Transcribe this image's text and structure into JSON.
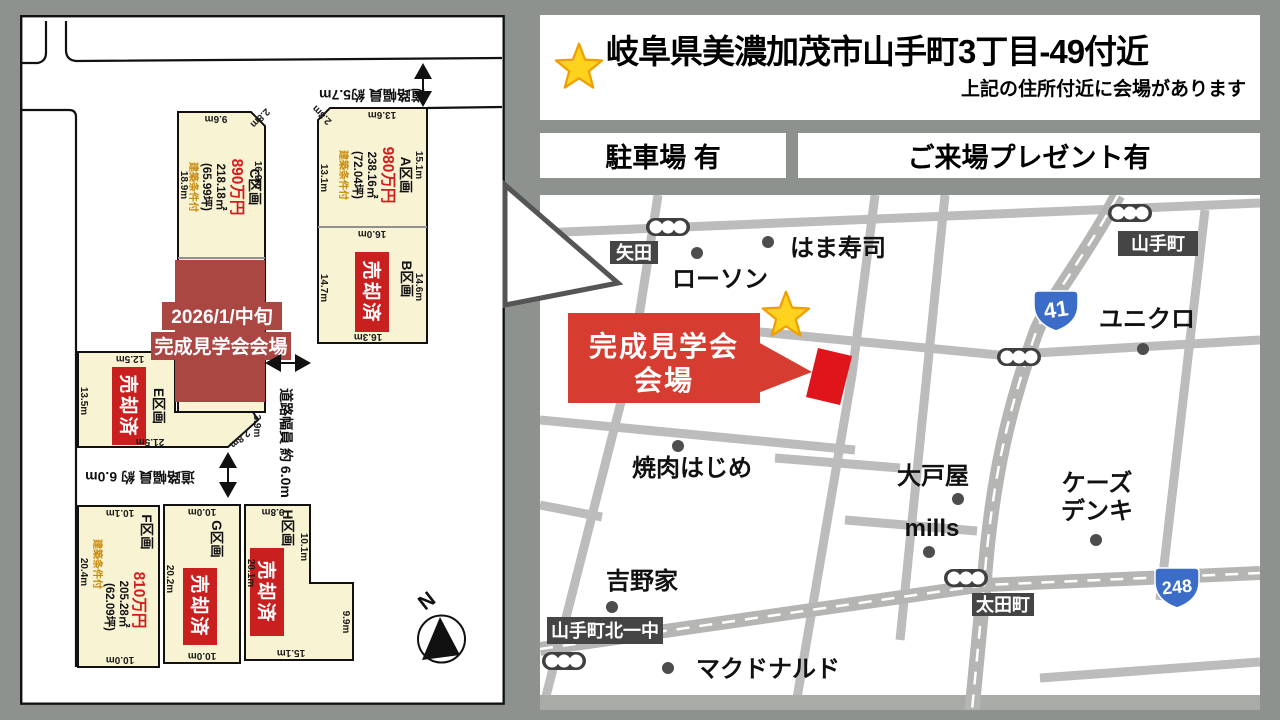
{
  "colors": {
    "page_bg": "#8e928f",
    "cream": "#f7f3d3",
    "sold_red": "#c91f1f",
    "price_red": "#d31c1c",
    "overlay_red": "#ab4743",
    "venue_red": "#d63c2f",
    "marker_red": "#e0151b",
    "condition_orange": "#c9890a",
    "road_gray": "#bcbcbc",
    "major_road_gray": "#b5b6b4",
    "label_dark": "#454545",
    "shield_blue": "#3a6cc8",
    "star_yellow": "#ffd21e",
    "star_border": "#ef9f00"
  },
  "header": {
    "title": "岐阜県美濃加茂市山手町3丁目‐49付近",
    "subtitle": "上記の住所付近に会場があります"
  },
  "badges": {
    "parking": "駐車場 有",
    "present": "ご来場プレゼント有"
  },
  "site_plan": {
    "overlay": {
      "line1": "2026/1/中旬",
      "line2": "完成見学会会場"
    },
    "sold_label": "売却済",
    "compass_label": "N",
    "road_notes": {
      "top": "道路幅員 約5.7m",
      "right": "道路幅員 約 6.0m",
      "bottom": "道路幅員 約 6.0m"
    },
    "plots": {
      "a": {
        "name": "A区画",
        "price": "980万円",
        "area": "238.16㎡",
        "tsubo": "(72.04坪)",
        "condition": "建築条件付",
        "dims": {
          "top": "13.6m",
          "corner": "2.8m",
          "right": "15.1m",
          "left": "13.1m",
          "bottom": "16.0m"
        }
      },
      "b": {
        "name": "B区画",
        "status": "売却済",
        "dims": {
          "right": "14.6m",
          "left": "14.7m",
          "bottom": "16.3m"
        }
      },
      "c": {
        "name": "C区画",
        "price": "890万円",
        "area": "218.18㎡",
        "tsubo": "(65.99坪)",
        "condition": "建築条件付",
        "dims": {
          "top": "9.6m",
          "corner": "2.8m",
          "right": "16.9m",
          "left": "18.9m"
        }
      },
      "e": {
        "name": "E区画",
        "status": "売却済",
        "dims": {
          "top": "12.5m",
          "left": "13.5m",
          "bottom": "21.5m",
          "diag_upper": "3.9m",
          "diag_lower": "2.8m"
        }
      },
      "f": {
        "name": "F区画",
        "price": "810万円",
        "area": "205.28㎡",
        "tsubo": "(62.09坪)",
        "condition": "建築条件付",
        "dims": {
          "top": "10.1m",
          "left": "20.4m",
          "bottom": "10.0m"
        }
      },
      "g": {
        "name": "G区画",
        "status": "売却済",
        "dims": {
          "top": "10.0m",
          "left": "20.2m",
          "bottom": "10.0m"
        }
      },
      "h": {
        "name": "H区画",
        "status": "売却済",
        "dims": {
          "top": "9.8m",
          "left": "20.1m",
          "right_upper": "10.1m",
          "right_lower": "9.9m",
          "bottom": "15.1m"
        }
      }
    }
  },
  "map": {
    "venue": {
      "line1": "完成見学会",
      "line2": "会場"
    },
    "routes": {
      "r41": "41",
      "r248": "248"
    },
    "area_labels": {
      "yada": "矢田",
      "yamatecho": "山手町",
      "otamachi": "太田町",
      "kitaichichu": "山手町北一中"
    },
    "landmarks": {
      "lawson": "ローソン",
      "hamazushi": "はま寿司",
      "uniqlo": "ユニクロ",
      "yakiniku": "焼肉はじめ",
      "yoshinoya": "吉野家",
      "mcdonalds": "マクドナルド",
      "ootoya": "大戸屋",
      "mills": "mills",
      "ksdenki_line1": "ケーズ",
      "ksdenki_line2": "デンキ"
    }
  }
}
